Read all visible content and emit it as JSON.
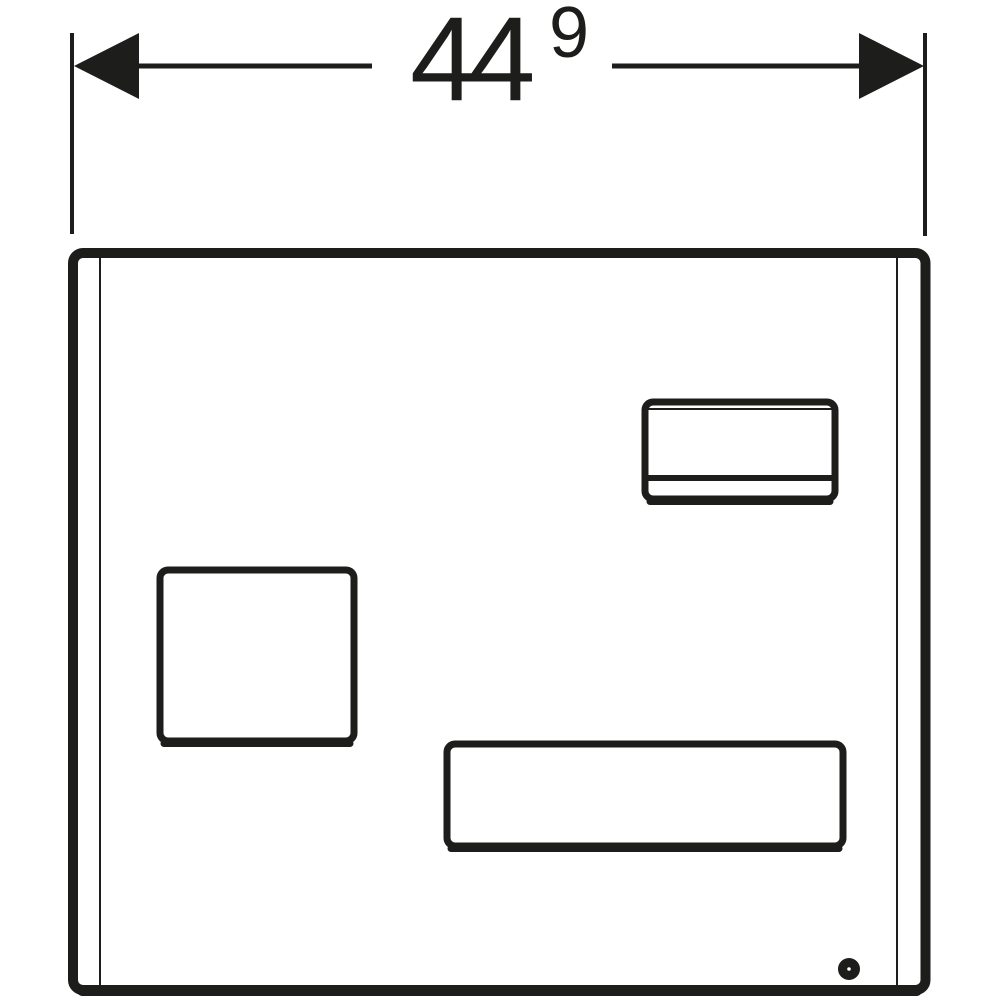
{
  "drawing": {
    "kind": "technical-dimension-drawing",
    "background_color": "#ffffff",
    "line_color": "#1d1d1b",
    "parts": [
      "width-dimension",
      "flush-plate-outline",
      "small-rect-button",
      "square-button",
      "wide-rect-button",
      "pivot-dot"
    ]
  },
  "dimension": {
    "value_main": "44",
    "value_superscript": "9"
  }
}
